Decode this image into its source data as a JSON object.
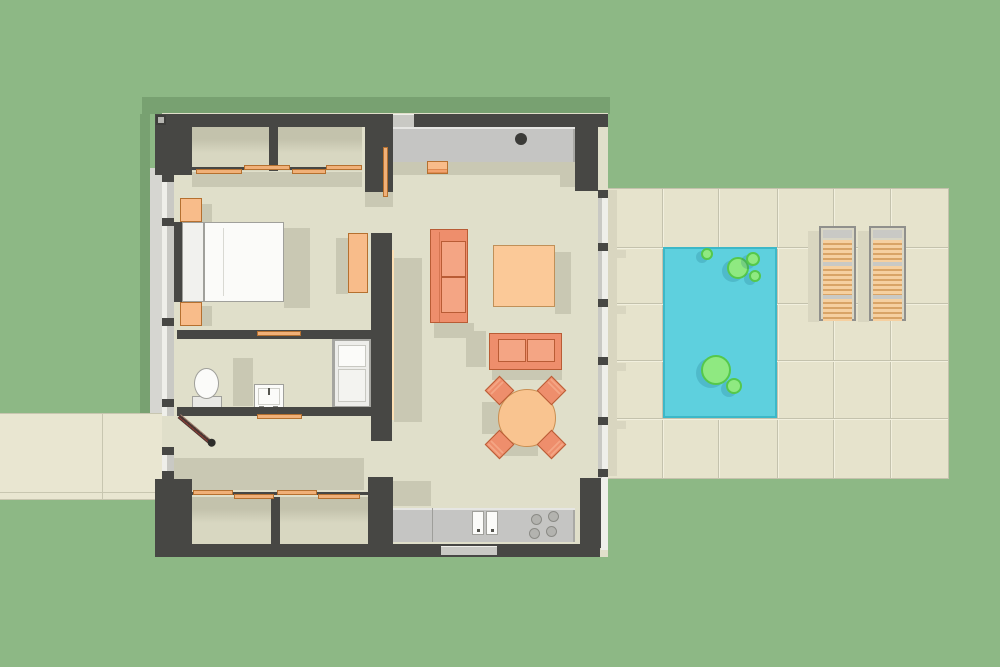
{
  "scene": {
    "title": "Studio house floor plan with pool terrace",
    "rooms": [
      "bedroom",
      "bathroom",
      "entry-hall",
      "living-kitchen",
      "closets",
      "pool-terrace"
    ],
    "furniture": [
      "double-bed",
      "nightstands",
      "toilet",
      "vanity-sink",
      "bathtub",
      "wardrobe",
      "three-seat-sofa",
      "loveseat",
      "square-ottoman",
      "round-dining-table",
      "dining-chairs",
      "kitchen-counter-with-sink",
      "cooktop",
      "sun-loungers",
      "pool-floats"
    ]
  },
  "palette": {
    "grass": "#8db885",
    "roofShadow": "#78a171",
    "wall": "#474744",
    "floor": "#e0dfca",
    "floorShadow": "#c9c8b3",
    "closetFloor": "#d8d7c1",
    "closetShadow": "#c3c2ac",
    "tile": "#e6e3cc",
    "tileLine": "#c4c2ad",
    "tileHi": "#f2f0de",
    "tileShadow": "#d9d6c0",
    "path": "#e9e6d1",
    "pathLine": "#c8c6b0",
    "pool": "#5ed0de",
    "poolBorder": "#3cb8c8",
    "float": "#8fe981",
    "floatBorder": "#55c84b",
    "counter": "#c5c5c3",
    "counterHi": "#e6e6e3",
    "counterEdge": "#a9a9a5",
    "applianceDark": "#3b3b38",
    "burner": "#b3b3af",
    "burnerEdge": "#8b8b86",
    "sofa": "#ee8e6c",
    "sofaCushion": "#f4a584",
    "sofaBorder": "#b95c35",
    "ottoman": "#fbc998",
    "ottomanBorder": "#c09058",
    "table": "#f9c490",
    "tableBorder": "#c98f52",
    "wood": "#f0b078",
    "woodBorder": "#b5702f",
    "woodHi": "#fde0b4",
    "nightstand": "#f8bc8a",
    "slat": "#f6d0a0",
    "slatLine": "#d9a466",
    "frameGray": "#90908c",
    "frameLight": "#c9c9c5",
    "loungerBed": "#d9d6c4",
    "whiteFurn": "#fbfbf9",
    "furnBorder": "#a0a09b",
    "glass": "#c9c9c4",
    "glassHi": "#efefea",
    "doorLeaf": "#4a3531",
    "doorStripe": "#8c3b33"
  },
  "exterior": {
    "shadows": [
      {
        "name": "roof-shadow-top",
        "x": 142,
        "y": 97,
        "w": 468,
        "h": 17
      },
      {
        "name": "roof-shadow-left",
        "x": 140,
        "y": 114,
        "w": 10,
        "h": 299
      }
    ],
    "path": {
      "x": 0,
      "y": 413,
      "w": 162,
      "h": 87,
      "lines": [
        {
          "x": 0,
          "y": 413,
          "w": 162,
          "h": 1
        },
        {
          "x": 0,
          "y": 492,
          "w": 162,
          "h": 1
        },
        {
          "x": 0,
          "y": 499,
          "w": 162,
          "h": 1
        },
        {
          "x": 102,
          "y": 414,
          "w": 1,
          "h": 85
        }
      ]
    },
    "sill": {
      "x": 150,
      "y": 168,
      "w": 12,
      "h": 312
    }
  },
  "patio": {
    "x": 608,
    "y": 189,
    "w": 340,
    "h": 289,
    "v_lines": [
      662,
      718,
      777,
      833,
      890
    ],
    "h_lines": [
      247,
      303,
      360,
      418
    ]
  },
  "pool": {
    "x": 663,
    "y": 247,
    "w": 114,
    "h": 171,
    "floats": [
      {
        "cx": 707,
        "cy": 254,
        "r": 6
      },
      {
        "cx": 738,
        "cy": 268,
        "r": 11
      },
      {
        "cx": 753,
        "cy": 259,
        "r": 7
      },
      {
        "cx": 755,
        "cy": 276,
        "r": 6
      },
      {
        "cx": 716,
        "cy": 370,
        "r": 15
      },
      {
        "cx": 734,
        "cy": 386,
        "r": 8
      }
    ]
  },
  "loungers": {
    "y": 226,
    "w": 37,
    "h": 95,
    "xs": [
      819,
      869
    ],
    "top_bar_h": 8,
    "sections": [
      {
        "y": 12,
        "h": 22
      },
      {
        "y": 38,
        "h": 29
      },
      {
        "y": 71,
        "h": 22
      }
    ],
    "dividers": [
      34,
      67
    ]
  },
  "shadows": {
    "patio": [
      {
        "name": "house-edge",
        "x": 608,
        "y": 190,
        "w": 9,
        "h": 286
      },
      {
        "name": "mullion-wedge",
        "x": 611,
        "y": 250,
        "w": 15,
        "h": 8
      },
      {
        "name": "mullion-wedge",
        "x": 611,
        "y": 306,
        "w": 15,
        "h": 8
      },
      {
        "name": "mullion-wedge",
        "x": 611,
        "y": 363,
        "w": 15,
        "h": 8
      },
      {
        "name": "mullion-wedge",
        "x": 611,
        "y": 421,
        "w": 15,
        "h": 8
      },
      {
        "name": "lounger-shadow",
        "x": 808,
        "y": 231,
        "w": 11,
        "h": 91
      },
      {
        "name": "lounger-shadow",
        "x": 858,
        "y": 231,
        "w": 11,
        "h": 91
      }
    ],
    "interior": [
      {
        "x": 393,
        "y": 162,
        "w": 182,
        "h": 13
      },
      {
        "x": 560,
        "y": 163,
        "w": 37,
        "h": 24
      },
      {
        "x": 192,
        "y": 172,
        "w": 170,
        "h": 15
      },
      {
        "x": 284,
        "y": 228,
        "w": 26,
        "h": 80
      },
      {
        "x": 202,
        "y": 204,
        "w": 10,
        "h": 20
      },
      {
        "x": 202,
        "y": 306,
        "w": 10,
        "h": 20
      },
      {
        "x": 336,
        "y": 238,
        "w": 12,
        "h": 56
      },
      {
        "x": 365,
        "y": 192,
        "w": 28,
        "h": 15
      },
      {
        "x": 394,
        "y": 258,
        "w": 28,
        "h": 164
      },
      {
        "x": 555,
        "y": 252,
        "w": 16,
        "h": 62
      },
      {
        "x": 434,
        "y": 323,
        "w": 40,
        "h": 15
      },
      {
        "x": 466,
        "y": 331,
        "w": 20,
        "h": 36
      },
      {
        "x": 492,
        "y": 370,
        "w": 70,
        "h": 10
      },
      {
        "x": 482,
        "y": 402,
        "w": 24,
        "h": 32
      },
      {
        "x": 504,
        "y": 444,
        "w": 34,
        "h": 12
      },
      {
        "x": 233,
        "y": 358,
        "w": 20,
        "h": 48
      },
      {
        "x": 172,
        "y": 458,
        "w": 192,
        "h": 32
      },
      {
        "x": 393,
        "y": 481,
        "w": 38,
        "h": 25
      }
    ]
  },
  "structure": {
    "floor": {
      "x": 162,
      "y": 113,
      "w": 446,
      "h": 444
    },
    "walls": [
      {
        "name": "top-wall",
        "x": 155,
        "y": 114,
        "w": 453,
        "h": 13
      },
      {
        "name": "corner-nw",
        "x": 155,
        "y": 114,
        "w": 37,
        "h": 61
      },
      {
        "name": "corner-ne",
        "x": 575,
        "y": 114,
        "w": 23,
        "h": 77
      },
      {
        "name": "corner-sw",
        "x": 155,
        "y": 479,
        "w": 37,
        "h": 78
      },
      {
        "name": "bottom-wall",
        "x": 155,
        "y": 544,
        "w": 445,
        "h": 13
      },
      {
        "name": "corner-se",
        "x": 580,
        "y": 478,
        "w": 22,
        "h": 70
      },
      {
        "name": "bedroom-east-upper",
        "x": 365,
        "y": 114,
        "w": 28,
        "h": 78
      },
      {
        "name": "bedroom-east-lower",
        "x": 371,
        "y": 233,
        "w": 21,
        "h": 208
      },
      {
        "name": "closet-divider-top",
        "x": 269,
        "y": 127,
        "w": 9,
        "h": 44
      },
      {
        "name": "closet-divider-bottom",
        "x": 271,
        "y": 497,
        "w": 9,
        "h": 47
      },
      {
        "name": "closet-corner",
        "x": 368,
        "y": 477,
        "w": 25,
        "h": 67
      },
      {
        "name": "bath-north-wall",
        "x": 177,
        "y": 330,
        "w": 195,
        "h": 9
      },
      {
        "name": "bath-south-wall",
        "x": 177,
        "y": 407,
        "w": 195,
        "h": 9
      },
      {
        "name": "bed-wall-segment",
        "x": 168,
        "y": 222,
        "w": 14,
        "h": 80
      }
    ],
    "closet_floors": [
      {
        "x": 192,
        "y": 127,
        "w": 170,
        "h": 44
      },
      {
        "x": 190,
        "y": 497,
        "w": 178,
        "h": 47
      }
    ],
    "tracks": [
      {
        "x": 192,
        "y": 167,
        "w": 170,
        "h": 3
      },
      {
        "x": 190,
        "y": 492,
        "w": 178,
        "h": 3
      }
    ],
    "glass_left": {
      "x": 162,
      "w": 12,
      "segments": [
        {
          "y": 174,
          "h": 242
        },
        {
          "y": 447,
          "h": 32
        }
      ],
      "mullion_ys": [
        174,
        218,
        318,
        399,
        447,
        471
      ]
    },
    "glass_right": {
      "x": 598,
      "w": 10,
      "y": 190,
      "h": 288,
      "mullion_ys": [
        190,
        243,
        299,
        357,
        417,
        469
      ],
      "lower_strip": {
        "x": 601,
        "y": 478,
        "w": 7,
        "h": 72
      }
    },
    "windows": [
      {
        "name": "north-window",
        "x": 390,
        "y": 114,
        "w": 27,
        "h": 13
      },
      {
        "name": "south-window",
        "x": 438,
        "y": 546,
        "w": 62,
        "h": 9
      }
    ]
  },
  "openings": {
    "wood_panels": [
      {
        "x": 196,
        "y": 169,
        "w": 46,
        "h": 5
      },
      {
        "x": 244,
        "y": 165,
        "w": 46,
        "h": 5
      },
      {
        "x": 292,
        "y": 169,
        "w": 34,
        "h": 5
      },
      {
        "x": 326,
        "y": 165,
        "w": 36,
        "h": 5
      },
      {
        "x": 193,
        "y": 490,
        "w": 40,
        "h": 5
      },
      {
        "x": 234,
        "y": 494,
        "w": 40,
        "h": 5
      },
      {
        "x": 277,
        "y": 490,
        "w": 40,
        "h": 5
      },
      {
        "x": 318,
        "y": 494,
        "w": 42,
        "h": 5
      },
      {
        "x": 257,
        "y": 331,
        "w": 44,
        "h": 5
      },
      {
        "x": 257,
        "y": 414,
        "w": 45,
        "h": 5
      },
      {
        "x": 383,
        "y": 147,
        "w": 5,
        "h": 50
      }
    ]
  },
  "dining": {
    "table": {
      "cx": 527,
      "cy": 418,
      "r": 29
    },
    "chairs": [
      {
        "cx": 499,
        "cy": 390,
        "rot": -45
      },
      {
        "cx": 551,
        "cy": 390,
        "rot": 45
      },
      {
        "cx": 499,
        "cy": 444,
        "rot": -135
      },
      {
        "cx": 551,
        "cy": 444,
        "rot": 135
      }
    ]
  },
  "kitchen": {
    "north_counter": {
      "x": 392,
      "y": 127,
      "w": 183,
      "h": 35,
      "basin": {
        "cx": 521,
        "cy": 139,
        "r": 6
      }
    },
    "south_counter": {
      "x": 392,
      "y": 508,
      "w": 183,
      "h": 34,
      "fridge_line_x": 432
    },
    "sinks": [
      {
        "x": 472,
        "y": 511,
        "w": 12,
        "h": 24
      },
      {
        "x": 486,
        "y": 511,
        "w": 12,
        "h": 24
      }
    ],
    "burners": [
      {
        "cx": 536,
        "cy": 519
      },
      {
        "cx": 553,
        "cy": 516
      },
      {
        "cx": 534,
        "cy": 533
      },
      {
        "cx": 551,
        "cy": 531
      }
    ],
    "burner_r": 5.5
  }
}
